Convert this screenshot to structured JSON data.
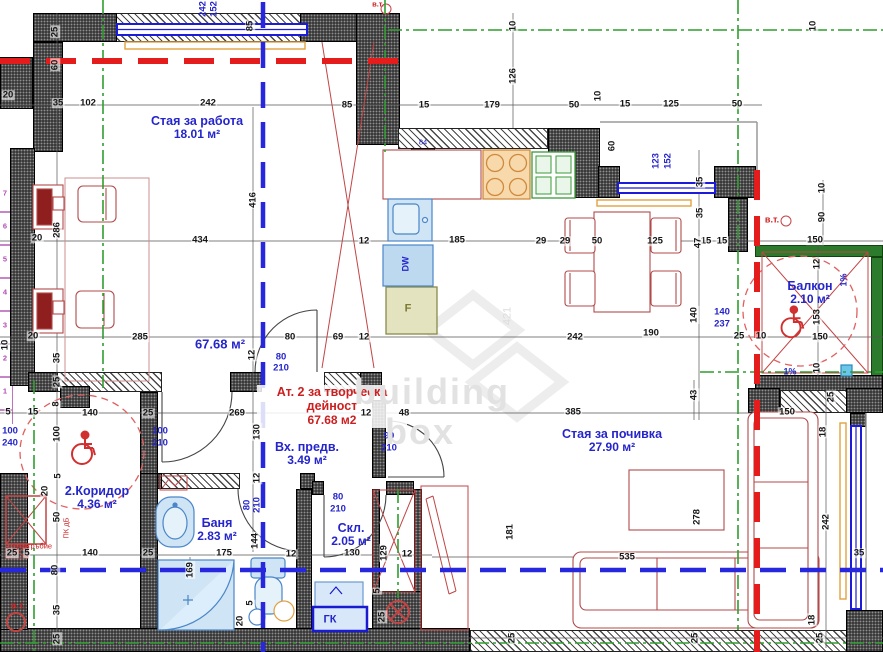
{
  "watermark": {
    "line1": "building",
    "line2": "box",
    "vertical": "421"
  },
  "colors": {
    "room_label": "#2525cc",
    "zone_label": "#cc1f1f",
    "walls_green": "#2c7a2c",
    "axis_green": "#2f9e2f",
    "axis_blue": "#2727dd",
    "fire_red": "#e51c1c",
    "furniture": "#b04a4a",
    "fixtures": "#4a86c8",
    "curtain": "#e2a23e"
  },
  "rooms": [
    {
      "name": "Стая за работа",
      "area": "18.01 м²",
      "x": 197,
      "y": 114,
      "cls": "blue"
    },
    {
      "name": "Вх. предв.",
      "area": "3.49 м²",
      "x": 307,
      "y": 440,
      "cls": "blue"
    },
    {
      "name": "2.Коридор",
      "area": "4.36 м²",
      "x": 97,
      "y": 484,
      "cls": "blue"
    },
    {
      "name": "Баня",
      "area": "2.83 м²",
      "x": 217,
      "y": 516,
      "cls": "blue"
    },
    {
      "name": "Скл.",
      "area": "2.05 м²",
      "x": 351,
      "y": 521,
      "cls": "blue"
    },
    {
      "name": "Стая за почивка",
      "area": "27.90 м²",
      "x": 612,
      "y": 427,
      "cls": "blue"
    },
    {
      "name": "Балкон",
      "area": "2.10 м²",
      "x": 810,
      "y": 279,
      "cls": "blue"
    },
    {
      "name": "Ат. 2 за творческа дейност",
      "area": "67.68 м2",
      "x": 332,
      "y": 385,
      "cls": "red"
    }
  ],
  "dimensions": [
    {
      "t": "20",
      "x": 8,
      "y": 95
    },
    {
      "t": "35",
      "x": 58,
      "y": 103
    },
    {
      "t": "102",
      "x": 88,
      "y": 103
    },
    {
      "t": "242",
      "x": 208,
      "y": 103
    },
    {
      "t": "85",
      "x": 347,
      "y": 105
    },
    {
      "t": "15",
      "x": 424,
      "y": 105
    },
    {
      "t": "179",
      "x": 492,
      "y": 105
    },
    {
      "t": "50",
      "x": 574,
      "y": 105
    },
    {
      "t": "10",
      "x": 598,
      "y": 96,
      "v": 1
    },
    {
      "t": "15",
      "x": 625,
      "y": 104
    },
    {
      "t": "125",
      "x": 671,
      "y": 104
    },
    {
      "t": "50",
      "x": 737,
      "y": 104
    },
    {
      "t": "25",
      "x": 55,
      "y": 32,
      "v": 1
    },
    {
      "t": "60",
      "x": 55,
      "y": 65,
      "v": 1
    },
    {
      "t": "85",
      "x": 250,
      "y": 26,
      "v": 1
    },
    {
      "t": "242",
      "x": 203,
      "y": 9,
      "v": 1,
      "c": "blue"
    },
    {
      "t": "152",
      "x": 214,
      "y": 9,
      "v": 1,
      "c": "blue"
    },
    {
      "t": "10",
      "x": 513,
      "y": 26,
      "v": 1
    },
    {
      "t": "126",
      "x": 513,
      "y": 76,
      "v": 1
    },
    {
      "t": "60",
      "x": 612,
      "y": 146,
      "v": 1
    },
    {
      "t": "10",
      "x": 813,
      "y": 26,
      "v": 1
    },
    {
      "t": "123",
      "x": 656,
      "y": 161,
      "v": 1,
      "c": "blue"
    },
    {
      "t": "152",
      "x": 668,
      "y": 161,
      "v": 1,
      "c": "blue"
    },
    {
      "t": "35",
      "x": 700,
      "y": 182,
      "v": 1
    },
    {
      "t": "35",
      "x": 700,
      "y": 213,
      "v": 1
    },
    {
      "t": "10",
      "x": 822,
      "y": 188,
      "v": 1
    },
    {
      "t": "90",
      "x": 822,
      "y": 217,
      "v": 1
    },
    {
      "t": "150",
      "x": 815,
      "y": 240
    },
    {
      "t": "12",
      "x": 817,
      "y": 264,
      "v": 1
    },
    {
      "t": "153",
      "x": 817,
      "y": 317,
      "v": 1
    },
    {
      "t": "150",
      "x": 820,
      "y": 337
    },
    {
      "t": "10",
      "x": 817,
      "y": 368,
      "v": 1
    },
    {
      "t": "15",
      "x": 706,
      "y": 241
    },
    {
      "t": "15",
      "x": 722,
      "y": 241
    },
    {
      "t": "47",
      "x": 698,
      "y": 243,
      "v": 1
    },
    {
      "t": "20",
      "x": 37,
      "y": 238
    },
    {
      "t": "286",
      "x": 57,
      "y": 230,
      "v": 1
    },
    {
      "t": "434",
      "x": 200,
      "y": 240
    },
    {
      "t": "12",
      "x": 364,
      "y": 241
    },
    {
      "t": "185",
      "x": 457,
      "y": 240
    },
    {
      "t": "29",
      "x": 541,
      "y": 241
    },
    {
      "t": "29",
      "x": 565,
      "y": 241
    },
    {
      "t": "50",
      "x": 597,
      "y": 241
    },
    {
      "t": "125",
      "x": 655,
      "y": 241
    },
    {
      "t": "416",
      "x": 253,
      "y": 200,
      "v": 1
    },
    {
      "t": "20",
      "x": 33,
      "y": 336
    },
    {
      "t": "285",
      "x": 140,
      "y": 337
    },
    {
      "t": "12",
      "x": 252,
      "y": 355,
      "v": 1
    },
    {
      "t": "80",
      "x": 290,
      "y": 337
    },
    {
      "t": "69",
      "x": 338,
      "y": 337
    },
    {
      "t": "12",
      "x": 364,
      "y": 337
    },
    {
      "t": "242",
      "x": 575,
      "y": 337
    },
    {
      "t": "190",
      "x": 651,
      "y": 333
    },
    {
      "t": "140",
      "x": 694,
      "y": 315,
      "v": 1
    },
    {
      "t": "25",
      "x": 739,
      "y": 336
    },
    {
      "t": "10",
      "x": 761,
      "y": 336
    },
    {
      "t": "140",
      "x": 722,
      "y": 312,
      "c": "blue"
    },
    {
      "t": "237",
      "x": 722,
      "y": 324,
      "c": "blue"
    },
    {
      "t": "35",
      "x": 57,
      "y": 358,
      "v": 1
    },
    {
      "t": "25",
      "x": 57,
      "y": 382,
      "v": 1
    },
    {
      "t": "10",
      "x": 5,
      "y": 345,
      "v": 1
    },
    {
      "t": "8",
      "x": 56,
      "y": 404,
      "v": 1
    },
    {
      "t": "5",
      "x": 8,
      "y": 412
    },
    {
      "t": "15",
      "x": 33,
      "y": 412
    },
    {
      "t": "140",
      "x": 90,
      "y": 413
    },
    {
      "t": "25",
      "x": 148,
      "y": 413
    },
    {
      "t": "269",
      "x": 237,
      "y": 413
    },
    {
      "t": "12",
      "x": 366,
      "y": 413
    },
    {
      "t": "48",
      "x": 404,
      "y": 413
    },
    {
      "t": "385",
      "x": 573,
      "y": 412
    },
    {
      "t": "43",
      "x": 694,
      "y": 395,
      "v": 1
    },
    {
      "t": "80",
      "x": 281,
      "y": 357,
      "c": "blue"
    },
    {
      "t": "210",
      "x": 281,
      "y": 368,
      "c": "blue"
    },
    {
      "t": "100",
      "x": 160,
      "y": 431,
      "c": "blue"
    },
    {
      "t": "210",
      "x": 160,
      "y": 443,
      "c": "blue"
    },
    {
      "t": "100",
      "x": 10,
      "y": 431,
      "c": "blue"
    },
    {
      "t": "240",
      "x": 10,
      "y": 443,
      "c": "blue"
    },
    {
      "t": "90",
      "x": 389,
      "y": 436,
      "c": "blue"
    },
    {
      "t": "210",
      "x": 389,
      "y": 448,
      "c": "blue"
    },
    {
      "t": "80",
      "x": 338,
      "y": 497,
      "c": "blue"
    },
    {
      "t": "210",
      "x": 338,
      "y": 509,
      "c": "blue"
    },
    {
      "t": "80",
      "x": 247,
      "y": 505,
      "v": 1,
      "c": "blue"
    },
    {
      "t": "210",
      "x": 257,
      "y": 505,
      "v": 1,
      "c": "blue"
    },
    {
      "t": "130",
      "x": 257,
      "y": 432,
      "v": 1
    },
    {
      "t": "12",
      "x": 257,
      "y": 478,
      "v": 1
    },
    {
      "t": "144",
      "x": 255,
      "y": 541,
      "v": 1
    },
    {
      "t": "100",
      "x": 57,
      "y": 434,
      "v": 1
    },
    {
      "t": "5",
      "x": 58,
      "y": 476,
      "v": 1
    },
    {
      "t": "20",
      "x": 45,
      "y": 491,
      "v": 1
    },
    {
      "t": "50",
      "x": 57,
      "y": 517,
      "v": 1
    },
    {
      "t": "25",
      "x": 12,
      "y": 553
    },
    {
      "t": "5",
      "x": 27,
      "y": 553
    },
    {
      "t": "140",
      "x": 90,
      "y": 553
    },
    {
      "t": "25",
      "x": 148,
      "y": 553
    },
    {
      "t": "175",
      "x": 224,
      "y": 553
    },
    {
      "t": "12",
      "x": 291,
      "y": 554
    },
    {
      "t": "130",
      "x": 352,
      "y": 553
    },
    {
      "t": "129",
      "x": 384,
      "y": 553,
      "v": 1
    },
    {
      "t": "12",
      "x": 407,
      "y": 554
    },
    {
      "t": "535",
      "x": 627,
      "y": 557
    },
    {
      "t": "169",
      "x": 190,
      "y": 570,
      "v": 1
    },
    {
      "t": "80",
      "x": 55,
      "y": 570,
      "v": 1
    },
    {
      "t": "35",
      "x": 57,
      "y": 610,
      "v": 1
    },
    {
      "t": "25",
      "x": 57,
      "y": 639,
      "v": 1
    },
    {
      "t": "20",
      "x": 240,
      "y": 621,
      "v": 1
    },
    {
      "t": "5",
      "x": 250,
      "y": 603,
      "v": 1
    },
    {
      "t": "5",
      "x": 377,
      "y": 591,
      "v": 1
    },
    {
      "t": "25",
      "x": 382,
      "y": 617,
      "v": 1
    },
    {
      "t": "181",
      "x": 510,
      "y": 532,
      "v": 1
    },
    {
      "t": "278",
      "x": 697,
      "y": 517,
      "v": 1
    },
    {
      "t": "25",
      "x": 512,
      "y": 638,
      "v": 1
    },
    {
      "t": "25",
      "x": 695,
      "y": 638,
      "v": 1
    },
    {
      "t": "150",
      "x": 787,
      "y": 412
    },
    {
      "t": "25",
      "x": 831,
      "y": 397,
      "v": 1
    },
    {
      "t": "18",
      "x": 823,
      "y": 432,
      "v": 1
    },
    {
      "t": "242",
      "x": 826,
      "y": 522,
      "v": 1
    },
    {
      "t": "35",
      "x": 859,
      "y": 553
    },
    {
      "t": "18",
      "x": 812,
      "y": 620,
      "v": 1
    },
    {
      "t": "25",
      "x": 820,
      "y": 638,
      "v": 1
    }
  ],
  "annotations": [
    {
      "t": "в.т.",
      "x": 772,
      "y": 220,
      "cls": "red small bold"
    },
    {
      "t": "в.т.",
      "x": 378,
      "y": 4,
      "cls": "red tiny bold"
    },
    {
      "t": "в.т.",
      "x": 18,
      "y": 606,
      "cls": "red small bold"
    },
    {
      "t": "ПК дБ",
      "x": 66,
      "y": 528,
      "cls": "red tiny vert"
    },
    {
      "t": "сухотръбие",
      "x": 32,
      "y": 546,
      "cls": "red tiny"
    },
    {
      "t": "1%",
      "x": 844,
      "y": 280,
      "cls": "blue small vert bold"
    },
    {
      "t": "1%",
      "x": 790,
      "y": 372,
      "cls": "blue small bold"
    },
    {
      "t": "ГК",
      "x": 330,
      "y": 620,
      "cls": "blue med"
    },
    {
      "t": "DW",
      "x": 406,
      "y": 264,
      "cls": "blue small vert bold"
    },
    {
      "t": "F",
      "x": 408,
      "y": 309,
      "cls": "olive med"
    },
    {
      "t": "84",
      "x": 423,
      "y": 142,
      "cls": "blue tiny"
    },
    {
      "t": "67.68 м²",
      "x": 220,
      "y": 344,
      "cls": "blueArea"
    },
    {
      "t": "building",
      "x": 432,
      "y": 392,
      "cls": "wm"
    },
    {
      "t": "box",
      "x": 420,
      "y": 432,
      "cls": "wm"
    },
    {
      "t": "421",
      "x": 508,
      "y": 316,
      "cls": "wmsm"
    }
  ],
  "stairs": {
    "numbers": [
      "7",
      "6",
      "5",
      "4",
      "3",
      "2",
      "1"
    ]
  }
}
